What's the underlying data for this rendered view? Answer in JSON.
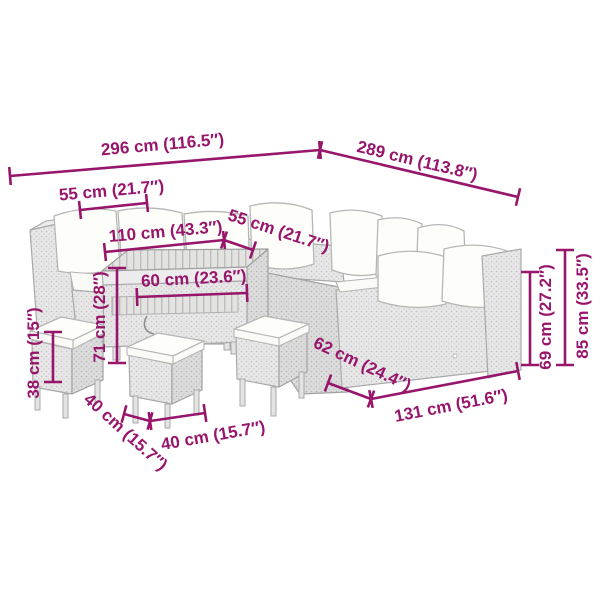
{
  "diagram": {
    "type": "product-dimension-diagram",
    "subject": "poly-rattan garden lounge set with corner sofas, table and stools"
  },
  "colors": {
    "dimension_accent": "#97156B",
    "furniture_fill": "#e7e7e7",
    "cushion_fill": "#fdfdfa",
    "outline": "#a9a9a9",
    "background": "#ffffff"
  },
  "dimensions": {
    "total_width": {
      "label": "296 cm (116.5″)"
    },
    "total_depth": {
      "label": "289 cm (113.8″)"
    },
    "left_seat_depth": {
      "label": "55 cm (21.7″)"
    },
    "table_length": {
      "label": "110 cm (43.3″)"
    },
    "right_seat_depth": {
      "label": "55 cm (21.7″)"
    },
    "table_top_depth": {
      "label": "60 cm (23.6″)"
    },
    "table_height": {
      "label": "71 cm (28″)"
    },
    "stool_height": {
      "label": "38 cm (15″)"
    },
    "stool_depth": {
      "label": "40 cm (15.7″)"
    },
    "stool_width": {
      "label": "40 cm (15.7″)"
    },
    "sofa_seat_depth": {
      "label": "62 cm (24.4″)"
    },
    "sofa_section_length": {
      "label": "131 cm (51.6″)"
    },
    "backrest_height": {
      "label": "69 cm (27.2″)"
    },
    "total_height": {
      "label": "85 cm (33.5″)"
    }
  }
}
